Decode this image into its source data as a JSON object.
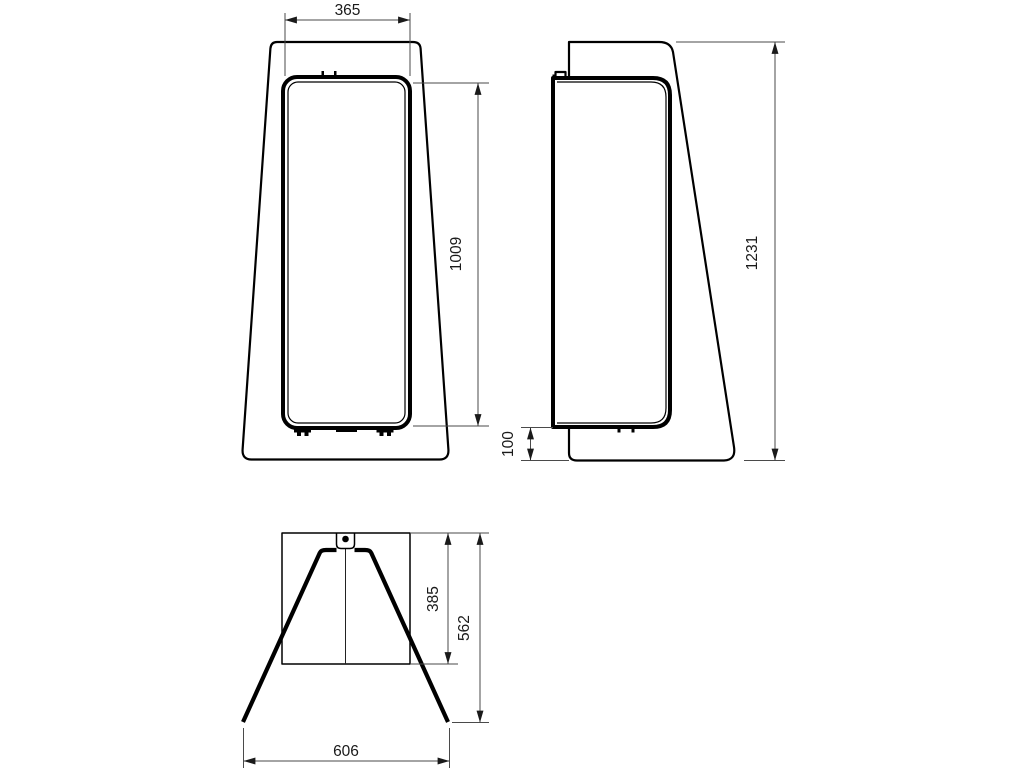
{
  "drawing": {
    "kind": "technical-dimension-drawing",
    "background_color": "#ffffff",
    "object_line_color": "#000000",
    "dimension_line_color": "#4a4a4a",
    "text_color": "#1a1a1a",
    "views": {
      "front": {
        "label": "front-view",
        "dims": {
          "top_width": "365",
          "panel_height": "1009"
        }
      },
      "side": {
        "label": "side-view",
        "dims": {
          "total_height": "1231",
          "bottom_offset": "100"
        }
      },
      "plan": {
        "label": "plan-view",
        "dims": {
          "body_depth": "385",
          "overall_depth": "562",
          "overall_width": "606"
        }
      }
    }
  }
}
